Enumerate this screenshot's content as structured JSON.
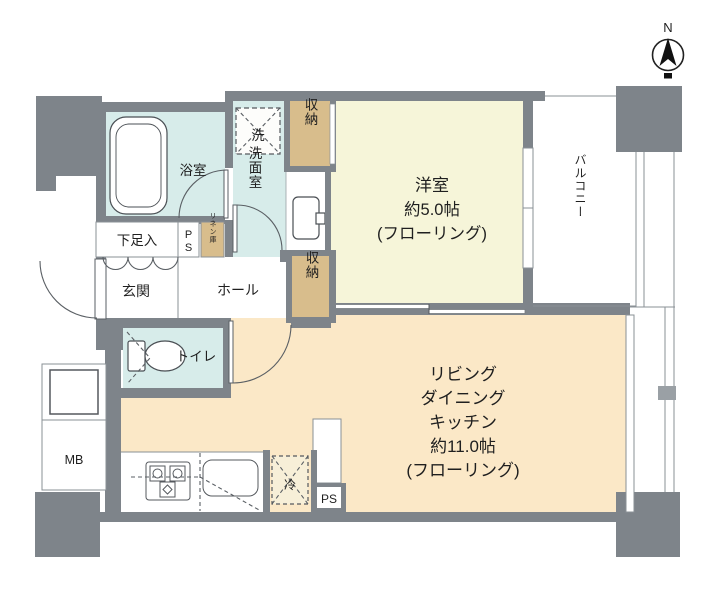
{
  "plan_title": "1LDK apartment floor plan",
  "compass": {
    "north_label": "N"
  },
  "rooms": {
    "bath": {
      "label": "浴室"
    },
    "washroom": {
      "label": "洗面室"
    },
    "entrance": {
      "label": "玄関"
    },
    "hall": {
      "label": "ホール"
    },
    "toilet": {
      "label": "トイレ"
    },
    "western_room": {
      "line1": "洋室",
      "line2": "約5.0帖",
      "line3": "(フローリング)"
    },
    "ldk": {
      "line1": "リビング",
      "line2": "ダイニング",
      "line3": "キッチン",
      "line4": "約11.0帖",
      "line5": "(フローリング)"
    },
    "balcony": {
      "label": "バルコニー"
    }
  },
  "fixtures": {
    "washer": {
      "label": "洗"
    },
    "fridge": {
      "label": "冷"
    },
    "shoe_cabinet": {
      "label": "下足入"
    },
    "pipe_space_top": {
      "letter1": "P",
      "letter2": "S"
    },
    "linen": {
      "label": "リネン庫"
    },
    "closet_upper": {
      "label": "収納"
    },
    "closet_hall": {
      "label": "収納"
    },
    "meter_box": {
      "label": "MB"
    },
    "pipe_space_bottom": {
      "label": "PS"
    }
  },
  "colors": {
    "wall": "#7e848a",
    "wet_area_floor": "#d7ecea",
    "western_room_floor": "#f6f5d9",
    "ldk_floor": "#fbe8c7",
    "storage_fill": "#d8bd8c",
    "fridge_bg": "#f7efd8"
  }
}
